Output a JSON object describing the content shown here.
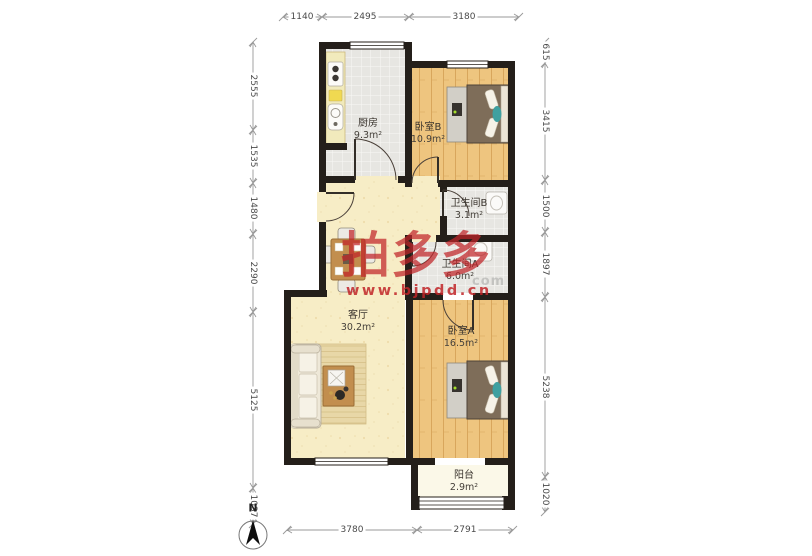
{
  "watermark": {
    "brand": "拍多多",
    "site": "www.bjpdd.cn",
    "ghost": "com"
  },
  "compass": {
    "label": "N"
  },
  "rooms": [
    {
      "name": "厨房",
      "area": "9.3m²"
    },
    {
      "name": "卧室B",
      "area": "10.9m²"
    },
    {
      "name": "卫生间B",
      "area": "3.1m²"
    },
    {
      "name": "卫生间A",
      "area": "6.0m²"
    },
    {
      "name": "客厅",
      "area": "30.2m²"
    },
    {
      "name": "卧室A",
      "area": "16.5m²"
    },
    {
      "name": "阳台",
      "area": "2.9m²"
    }
  ],
  "dimensions_mm": {
    "top": [
      "1140",
      "2495",
      "3180"
    ],
    "bottom": [
      "3780",
      "2791"
    ],
    "left": [
      "2555",
      "1535",
      "1480",
      "2290",
      "5125",
      "1037"
    ],
    "right": [
      "615",
      "3415",
      "1500",
      "1897",
      "5238",
      "1020"
    ]
  },
  "colors": {
    "wall": "#241f1a",
    "wood_floor": "#eec57f",
    "tile_floor": "#e7e6e2",
    "hall_floor": "#f7edc6",
    "balcony_floor": "#fbf8e8",
    "watermark_red": "#c12428",
    "dim_line": "#999999"
  }
}
